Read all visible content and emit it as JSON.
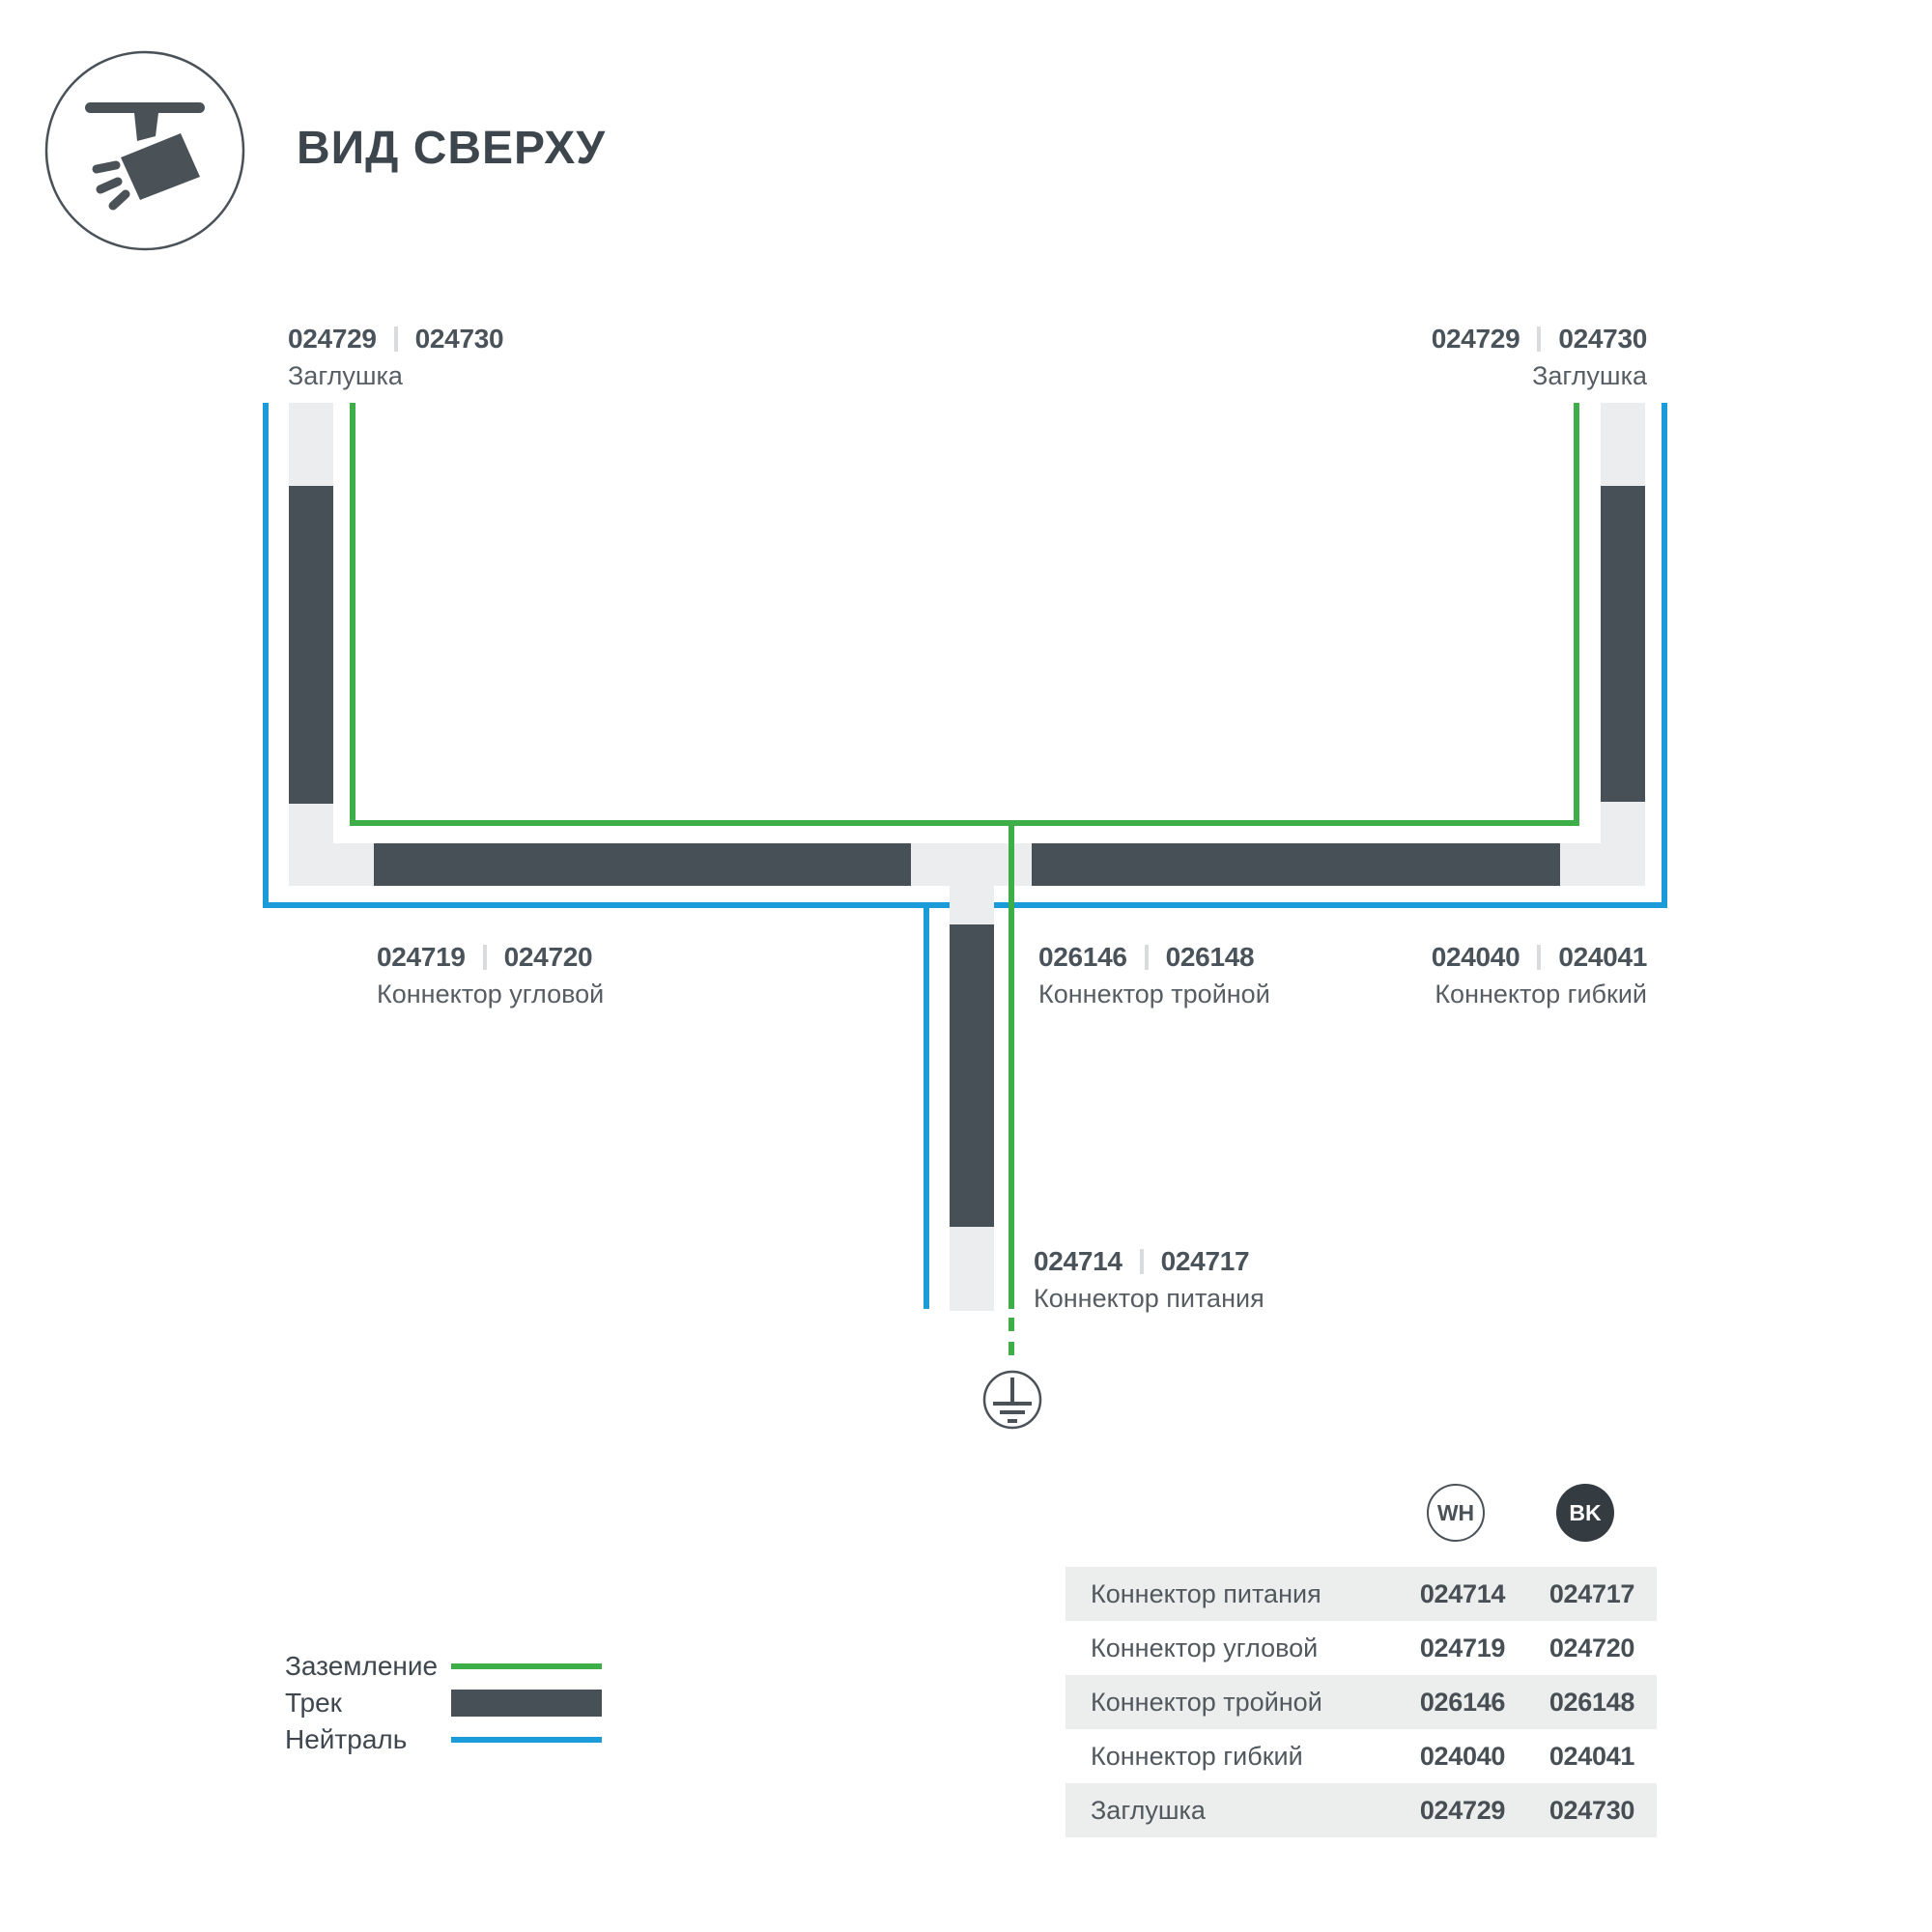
{
  "header": {
    "title": "ВИД СВЕРХУ",
    "icon": "track-spotlight-icon"
  },
  "colors": {
    "ground_green": "#3EAE49",
    "neutral_blue": "#1B9CD8",
    "track_dark": "#475056",
    "track_light": "#ECEDEE",
    "text_dark": "#3E464D",
    "text_gray": "#565D63",
    "bk_chip": "#343B41"
  },
  "diagram": {
    "labels": {
      "endcap_left": {
        "codes": [
          "024729",
          "024730"
        ],
        "name": "Заглушка"
      },
      "endcap_right": {
        "codes": [
          "024729",
          "024730"
        ],
        "name": "Заглушка"
      },
      "corner": {
        "codes": [
          "024719",
          "024720"
        ],
        "name": "Коннектор угловой"
      },
      "triple": {
        "codes": [
          "026146",
          "026148"
        ],
        "name": "Коннектор тройной"
      },
      "flex": {
        "codes": [
          "024040",
          "024041"
        ],
        "name": "Коннектор гибкий"
      },
      "power": {
        "codes": [
          "024714",
          "024717"
        ],
        "name": "Коннектор питания"
      }
    },
    "ground_symbol": "earth-ground"
  },
  "legend": {
    "items": [
      {
        "label": "Заземление",
        "swatch": "ground-green-line"
      },
      {
        "label": "Трек",
        "swatch": "track-dark-bar"
      },
      {
        "label": "Нейтраль",
        "swatch": "neutral-blue-line"
      }
    ]
  },
  "table": {
    "columns": [
      "WH",
      "BK"
    ],
    "rows": [
      {
        "name": "Коннектор питания",
        "wh": "024714",
        "bk": "024717"
      },
      {
        "name": "Коннектор угловой",
        "wh": "024719",
        "bk": "024720"
      },
      {
        "name": "Коннектор тройной",
        "wh": "026146",
        "bk": "026148"
      },
      {
        "name": "Коннектор гибкий",
        "wh": "024040",
        "bk": "024041"
      },
      {
        "name": "Заглушка",
        "wh": "024729",
        "bk": "024730"
      }
    ]
  }
}
